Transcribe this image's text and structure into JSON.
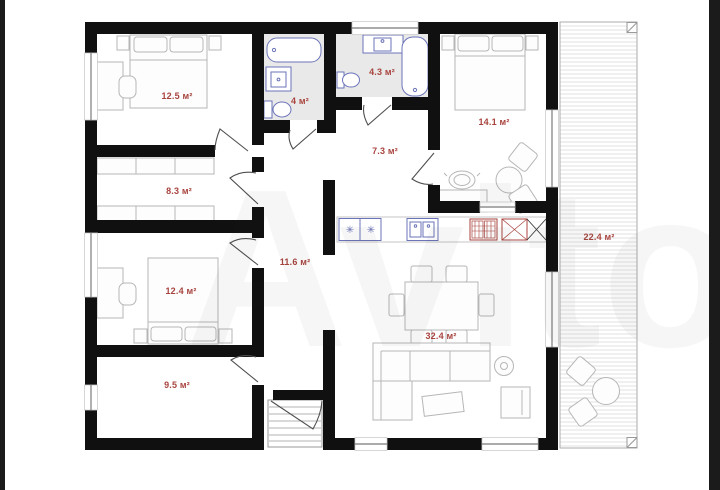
{
  "watermark": {
    "text": "Avito"
  },
  "plan": {
    "type": "floor-plan",
    "area_unit": "м²",
    "rooms": [
      {
        "id": "bedroom-top-left",
        "area_label": "12.5 м²"
      },
      {
        "id": "wardrobe-room",
        "area_label": "8.3 м²"
      },
      {
        "id": "bedroom-mid-left",
        "area_label": "12.4 м²"
      },
      {
        "id": "room-bottom-left",
        "area_label": "9.5 м²"
      },
      {
        "id": "bathroom-small",
        "area_label": "4 м²"
      },
      {
        "id": "bathroom-large",
        "area_label": "4.3 м²"
      },
      {
        "id": "hallway",
        "area_label": "7.3 м²"
      },
      {
        "id": "bedroom-right",
        "area_label": "14.1 м²"
      },
      {
        "id": "corridor",
        "area_label": "11.6 м²"
      },
      {
        "id": "kitchen-living-room",
        "area_label": "32.4 м²"
      },
      {
        "id": "terrace",
        "area_label": "22.4 м²"
      }
    ],
    "icons": {
      "hob_burner": "✳"
    },
    "colors": {
      "wall": "#101010",
      "room_label": "#a8433e",
      "fixture_blue": "#6b74b8",
      "fixture_red": "#a8433e",
      "furniture_outline": "#b6b6b6",
      "bathroom_floor": "#e9e9e9",
      "border_band": "#1b1b1b"
    }
  }
}
